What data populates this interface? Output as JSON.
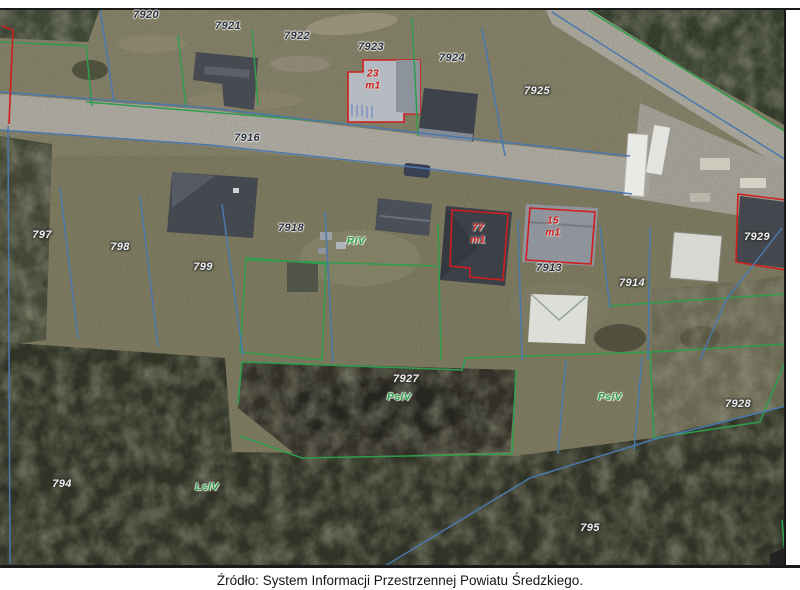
{
  "caption": {
    "text": "Źródło: System Informacji Przestrzennej Powiatu Średzkiego."
  },
  "map": {
    "colors": {
      "parcel_boundary_blue": "#4a78ad",
      "land_use_boundary_green": "#2e9e4d",
      "building_outline_red": "#cf1d1d",
      "road_surface": "#c7c3b9",
      "grass": "#908d6f",
      "forest": "#393d2d"
    },
    "labels": [
      {
        "text": "7920",
        "x": 146,
        "y": 15,
        "kind": "parcel-dark"
      },
      {
        "text": "7921",
        "x": 228,
        "y": 26,
        "kind": "parcel-dark"
      },
      {
        "text": "7922",
        "x": 297,
        "y": 36,
        "kind": "parcel-dark"
      },
      {
        "text": "7923",
        "x": 371,
        "y": 47,
        "kind": "parcel-dark"
      },
      {
        "text": "7924",
        "x": 452,
        "y": 58,
        "kind": "parcel-dark"
      },
      {
        "text": "7925",
        "x": 537,
        "y": 91,
        "kind": "parcel-light"
      },
      {
        "text": "7916",
        "x": 247,
        "y": 138,
        "kind": "parcel-dark"
      },
      {
        "text": "797",
        "x": 42,
        "y": 235,
        "kind": "parcel-light"
      },
      {
        "text": "798",
        "x": 120,
        "y": 247,
        "kind": "parcel-light"
      },
      {
        "text": "799",
        "x": 203,
        "y": 267,
        "kind": "parcel-light"
      },
      {
        "text": "7918",
        "x": 291,
        "y": 228,
        "kind": "parcel-dark"
      },
      {
        "text": "RIV",
        "x": 356,
        "y": 241,
        "kind": "soil"
      },
      {
        "text": "7913",
        "x": 549,
        "y": 268,
        "kind": "parcel-dark"
      },
      {
        "text": "7914",
        "x": 632,
        "y": 283,
        "kind": "parcel-light"
      },
      {
        "text": "7929",
        "x": 757,
        "y": 237,
        "kind": "parcel-light"
      },
      {
        "text": "7927",
        "x": 406,
        "y": 379,
        "kind": "parcel-light"
      },
      {
        "text": "PsIV",
        "x": 399,
        "y": 397,
        "kind": "soil"
      },
      {
        "text": "PsIV",
        "x": 610,
        "y": 397,
        "kind": "soil"
      },
      {
        "text": "7928",
        "x": 738,
        "y": 404,
        "kind": "parcel-light"
      },
      {
        "text": "794",
        "x": 62,
        "y": 484,
        "kind": "parcel-light"
      },
      {
        "text": "LsIV",
        "x": 207,
        "y": 487,
        "kind": "soil"
      },
      {
        "text": "795",
        "x": 590,
        "y": 528,
        "kind": "parcel-light"
      },
      {
        "text": "23",
        "x": 373,
        "y": 74,
        "kind": "building"
      },
      {
        "text": "m1",
        "x": 373,
        "y": 86,
        "kind": "building"
      },
      {
        "text": "77",
        "x": 478,
        "y": 228,
        "kind": "building"
      },
      {
        "text": "m1",
        "x": 478,
        "y": 240,
        "kind": "building"
      },
      {
        "text": "15",
        "x": 553,
        "y": 221,
        "kind": "building"
      },
      {
        "text": "m1",
        "x": 553,
        "y": 233,
        "kind": "building"
      }
    ]
  }
}
